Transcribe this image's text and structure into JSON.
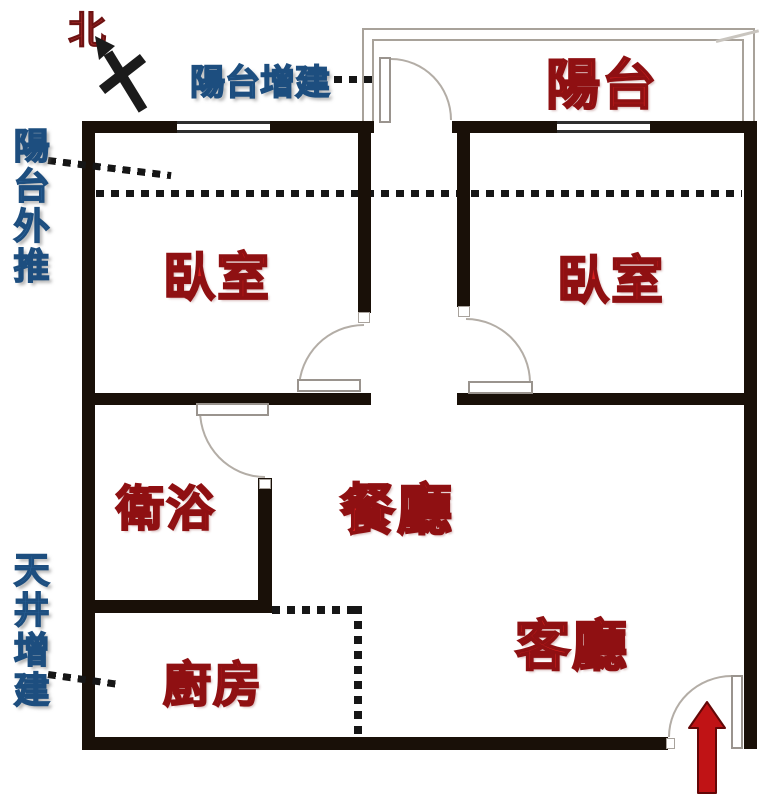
{
  "compass": {
    "north": "北"
  },
  "rooms": {
    "balcony": {
      "label": "陽台"
    },
    "bedroom_left": {
      "label": "臥室"
    },
    "bedroom_right": {
      "label": "臥室"
    },
    "bathroom": {
      "label": "衛浴"
    },
    "dining_room": {
      "label": "餐廳"
    },
    "living_room": {
      "label": "客廳"
    },
    "kitchen": {
      "label": "廚房"
    }
  },
  "annotations": {
    "balcony_addition": {
      "label": "陽台增建"
    },
    "balcony_pushout": {
      "label": "陽台外推"
    },
    "lightwell_addition": {
      "label": "天井增建"
    }
  },
  "colors": {
    "wall": "#191008",
    "room_label": "#d8201f",
    "room_label_outline": "#8f1012",
    "annotation_label": "#3a7ab6",
    "annotation_outline": "#1d4e7f",
    "north_label": "#a22a28",
    "entry_arrow": "#c01315",
    "door_arc": "#b3ada6",
    "balcony_wall": "#a8a29a"
  }
}
